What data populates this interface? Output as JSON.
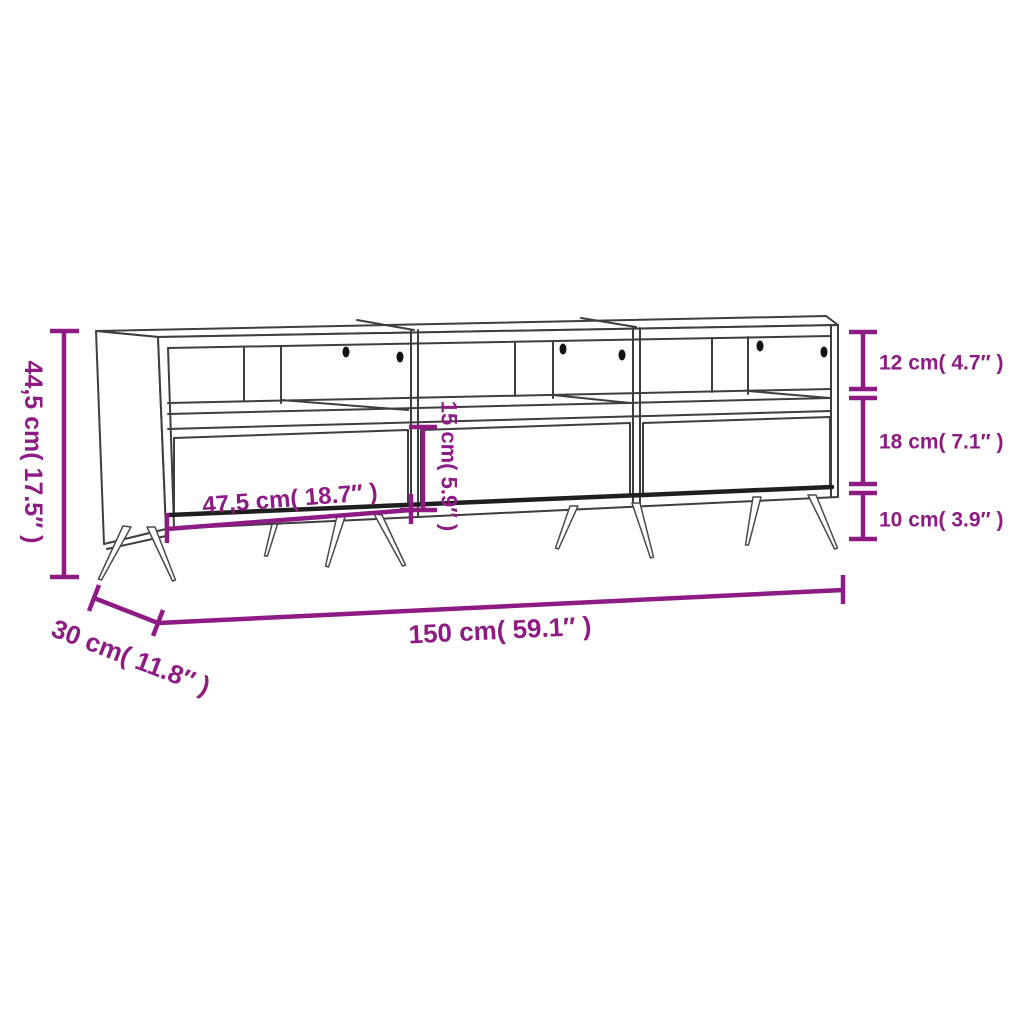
{
  "title": "TV cabinet dimension diagram",
  "colors": {
    "accent": "#8E1B84",
    "line": "#3E3E3E",
    "background": "#FFFFFF",
    "hole": "#111111"
  },
  "dimensions": {
    "overall_height": "44,5 cm( 17.5″ )",
    "overall_width": "150 cm( 59.1″ )",
    "overall_depth": "30 cm( 11.8″ )",
    "shelf_compartment_height": "12 cm( 4.7″ )",
    "drawer_front_height": "18 cm( 7.1″ )",
    "leg_height": "10 cm( 3.9″ )",
    "drawer_width": "47,5 cm( 18.7″ )",
    "drawer_opening_height": "15 cm( 5.9″ )"
  }
}
